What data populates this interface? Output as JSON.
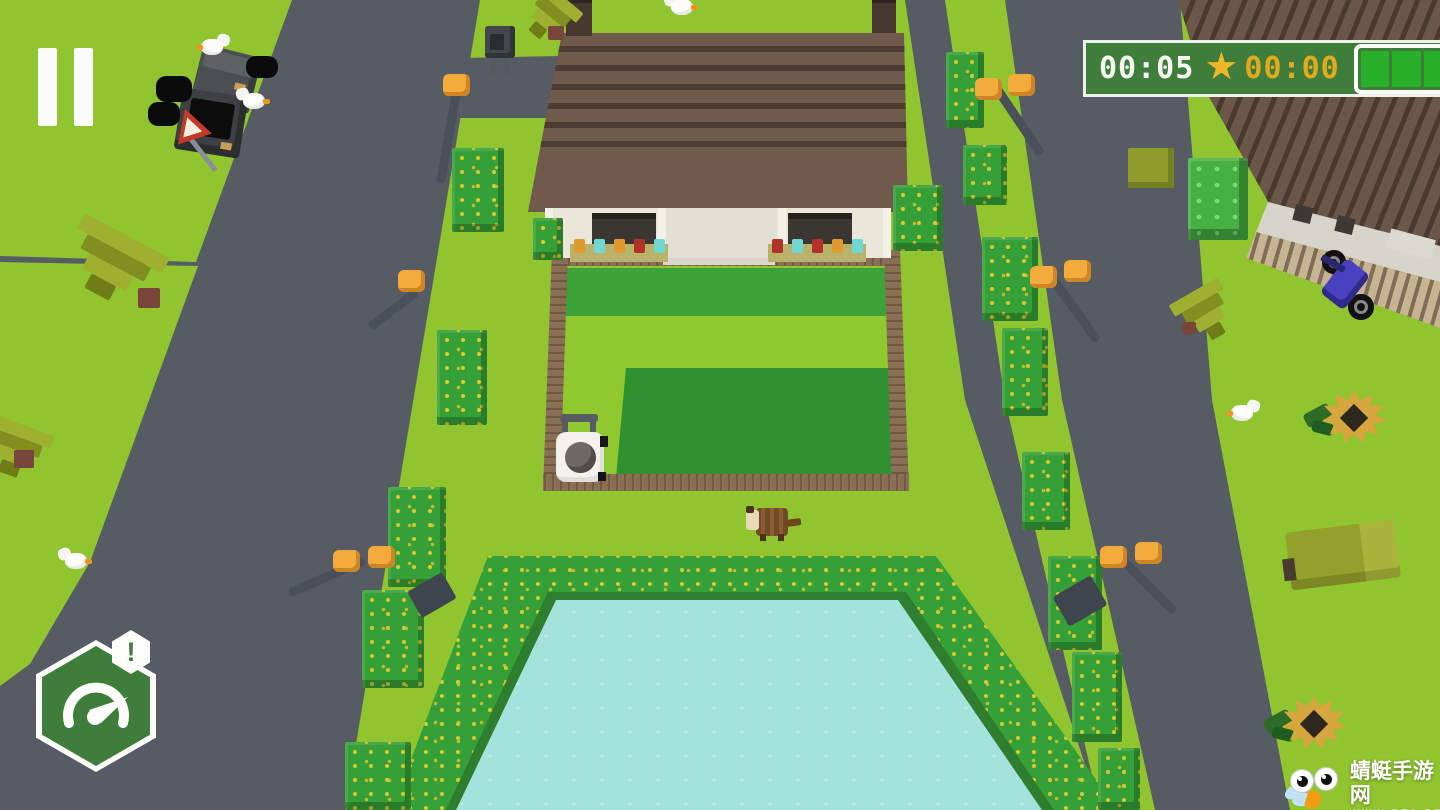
{
  "hud": {
    "timer": "00:05",
    "star_glyph": "★",
    "star_time": "00:00",
    "battery": {
      "segments": 3,
      "filled": 3
    }
  },
  "badge": {
    "alert": "!"
  },
  "watermark": {
    "title": "蜻蜓手游网",
    "url": "WWW.QT6.COM"
  },
  "palette": {
    "grass": "#90c52f",
    "road": "#575b64",
    "hud_green": "#3e7d3a",
    "gold": "#f0b62a",
    "battery_green": "#28b128",
    "pool_water": "#a4e3db",
    "hedge_green": "#35a037",
    "roof_brown": "#6f5a4b",
    "fence_brown": "#8a6f54"
  }
}
